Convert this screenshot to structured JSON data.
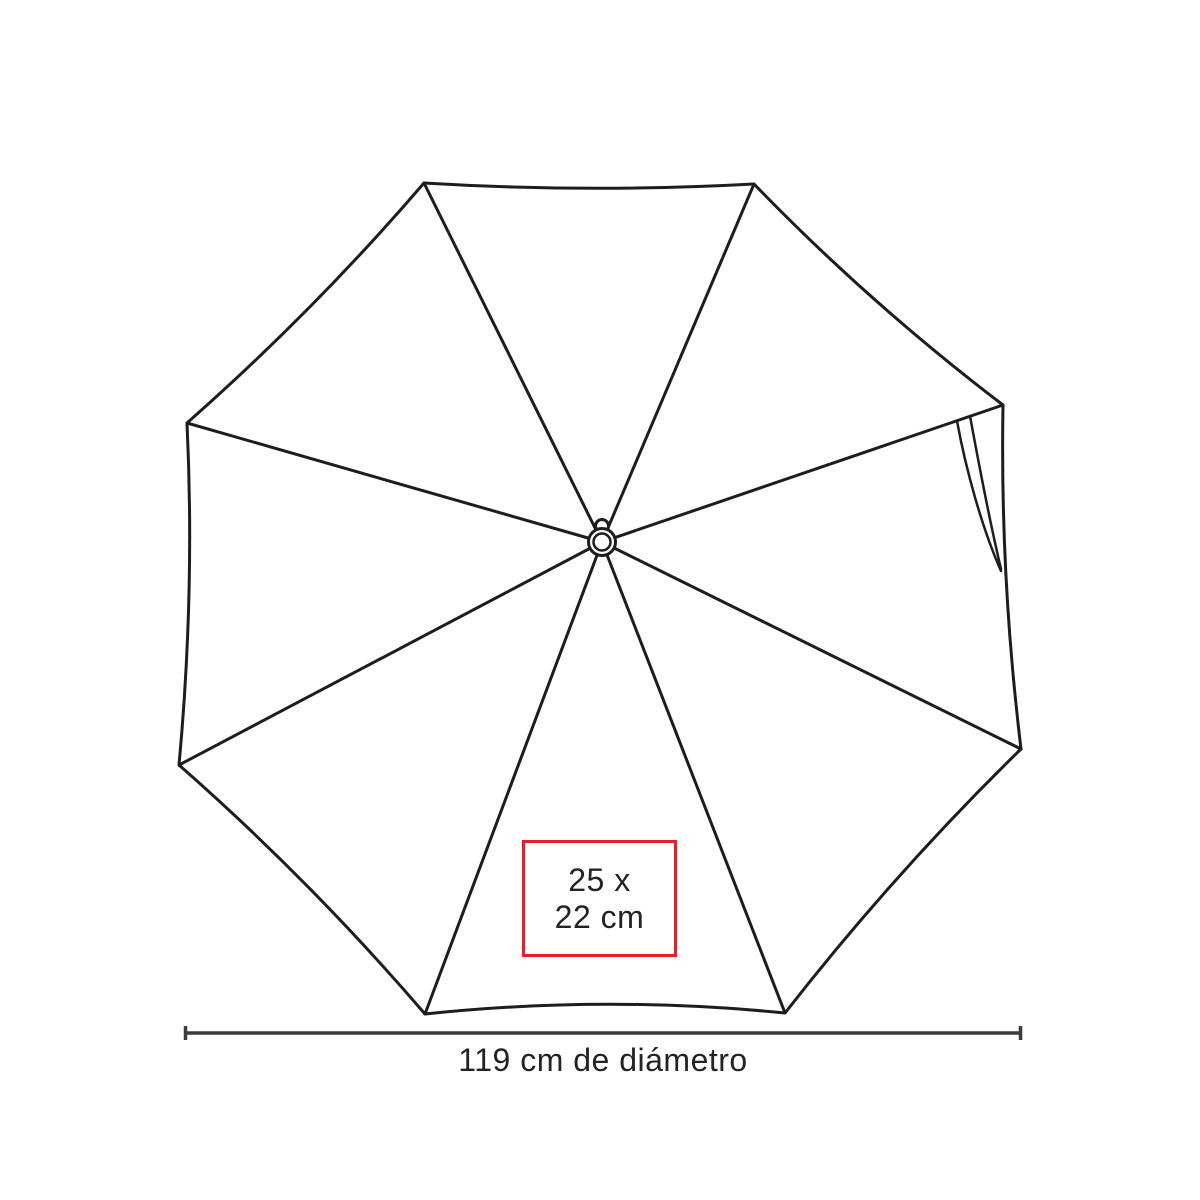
{
  "colors": {
    "background": "#ffffff",
    "line": "#1d1d1b",
    "dimension": "#3d3d3d",
    "text": "#232323",
    "accent": "#ec1c24"
  },
  "diagram": {
    "subject": "umbrella-top-view",
    "panels": 8,
    "print_area": {
      "line1": "25 x",
      "line2": "22 cm"
    },
    "dimension": {
      "label": "119 cm de diámetro"
    }
  }
}
